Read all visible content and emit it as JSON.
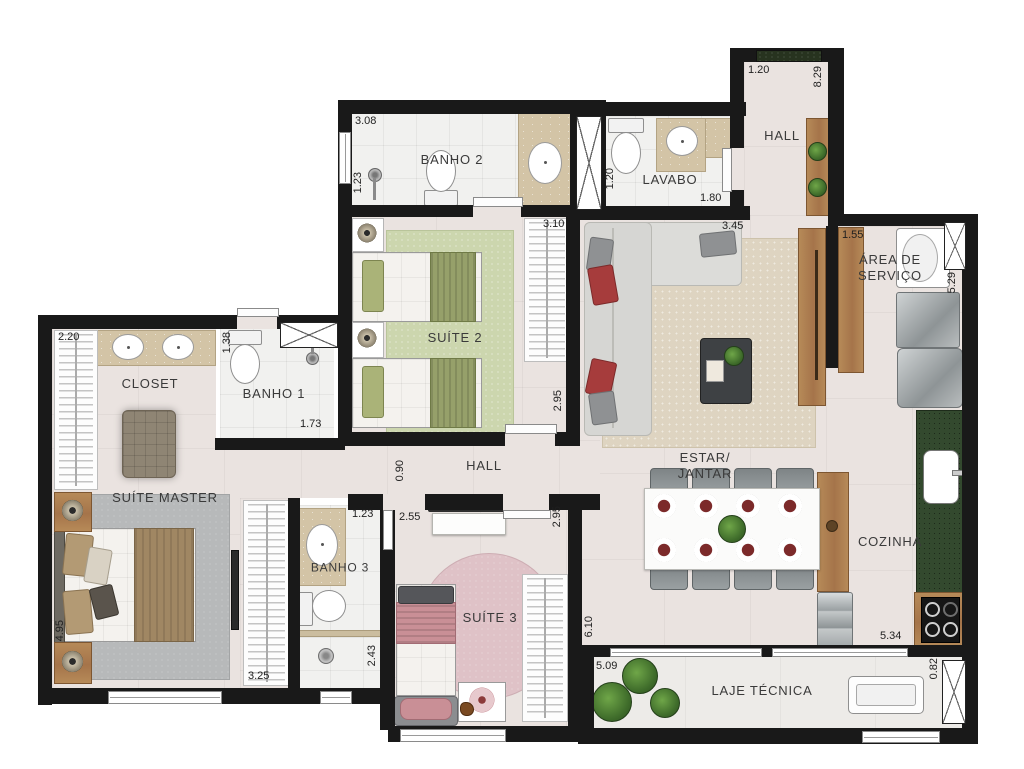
{
  "plan_title": "Apartment floor plan",
  "colors": {
    "wall": "#191919",
    "floor": "#eae3e0",
    "bath_floor": "#f1f1ef",
    "rug_suite2": "#ccd6ae",
    "rug_suite3": "#dfc2c7",
    "rug_master": "#b7b9ba",
    "rug_estar": "#ded4c1",
    "counter_beige": "#d3c4a6",
    "counter_green": "#33492e",
    "wood": "#ab7a4d",
    "accent_red": "#a63c3c",
    "accent_pink": "#c98f96"
  },
  "rooms": {
    "banho2": {
      "label": "BANHO 2",
      "dim_w": "3.08",
      "dim_h": "1.23"
    },
    "lavabo": {
      "label": "LAVABO",
      "dim_h": "1.20",
      "dim_w": "1.80"
    },
    "hall_entrada": {
      "label": "HALL",
      "dim_w": "1.20",
      "dim_h": "8.29"
    },
    "area_servico": {
      "label_line1": "ÁREA DE",
      "label_line2": "SERVIÇO",
      "dim_w": "1.55",
      "dim_h": "5.29"
    },
    "suite2": {
      "label": "SUÍTE 2",
      "dim_w": "3.10",
      "dim_h": "2.95"
    },
    "closet": {
      "label": "CLOSET",
      "dim_w": "2.20"
    },
    "banho1": {
      "label": "BANHO 1",
      "dim_h": "1.38",
      "dim_w": "1.73"
    },
    "suite_master": {
      "label": "SUÍTE MASTER",
      "dim_h": "4.95",
      "dim_w": "3.25"
    },
    "hall_intimo": {
      "label": "HALL",
      "dim_h": "0.90"
    },
    "banho3": {
      "label": "BANHO 3",
      "dim_w": "1.23",
      "dim_h": "2.43"
    },
    "suite3": {
      "label": "SUÍTE 3",
      "dim_w": "2.55",
      "dim_h": "2.95"
    },
    "estar": {
      "label_line1": "ESTAR/",
      "label_line2": "JANTAR",
      "dim_w": "3.45"
    },
    "cozinha": {
      "label": "COZINHA",
      "dim_w": "5.34",
      "dim_h": "6.10"
    },
    "laje": {
      "label": "LAJE TÉCNICA",
      "dim_w": "5.09",
      "dim_h": "0.82"
    }
  }
}
